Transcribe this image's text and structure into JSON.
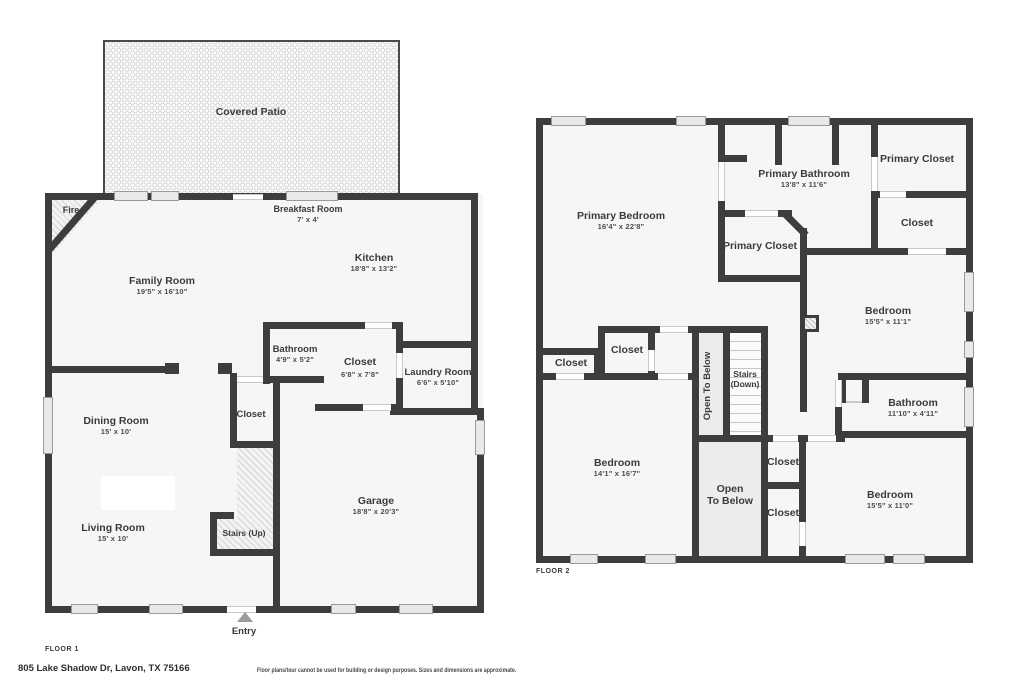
{
  "colors": {
    "wall": "#3d3d3d",
    "floor": "#f6f6f6",
    "background": "#ffffff",
    "shaded": "#ececec",
    "label_text": "#3b3b3b"
  },
  "footer": {
    "address": "805 Lake Shadow Dr, Lavon, TX 75166",
    "disclaimer": "Floor plans/tour cannot be used for building or design purposes. Sizes and dimensions are approximate."
  },
  "floor1": {
    "label": "FLOOR 1",
    "rooms": {
      "covered_patio": {
        "name": "Covered Patio"
      },
      "breakfast": {
        "name": "Breakfast Room",
        "dims": "7' x 4'"
      },
      "kitchen": {
        "name": "Kitchen",
        "dims": "18'8\" x 13'2\""
      },
      "family": {
        "name": "Family Room",
        "dims": "19'5\" x 16'10\""
      },
      "fire": {
        "name": "Fire"
      },
      "bathroom": {
        "name": "Bathroom",
        "dims": "4'9\" x 5'2\""
      },
      "closet_center": {
        "name": "Closet",
        "dims": "6'8\" x 7'8\""
      },
      "laundry": {
        "name": "Laundry Room",
        "dims": "6'6\" x 5'10\""
      },
      "dining": {
        "name": "Dining Room",
        "dims": "15' x 10'"
      },
      "closet_stairs": {
        "name": "Closet"
      },
      "living": {
        "name": "Living Room",
        "dims": "15' x 10'"
      },
      "stairs": {
        "name": "Stairs (Up)"
      },
      "garage": {
        "name": "Garage",
        "dims": "18'8\" x 20'3\""
      },
      "entry": {
        "name": "Entry"
      }
    }
  },
  "floor2": {
    "label": "FLOOR 2",
    "rooms": {
      "primary_bedroom": {
        "name": "Primary Bedroom",
        "dims": "16'4\" x 22'8\""
      },
      "primary_bathroom": {
        "name": "Primary Bathroom",
        "dims": "13'8\" x 11'6\""
      },
      "primary_closet_tr": {
        "name": "Primary Closet"
      },
      "closet_r": {
        "name": "Closet"
      },
      "primary_closet_mid": {
        "name": "Primary Closet"
      },
      "bedroom_ne": {
        "name": "Bedroom",
        "dims": "15'5\" x 11'1\""
      },
      "closet_l": {
        "name": "Closet"
      },
      "closet_m": {
        "name": "Closet"
      },
      "open_below_col": {
        "name": "Open To Below"
      },
      "stairs_down": {
        "line1": "Stairs",
        "line2": "(Down)"
      },
      "bathroom": {
        "name": "Bathroom",
        "dims": "11'10\" x 4'11\""
      },
      "bedroom_w": {
        "name": "Bedroom",
        "dims": "14'1\" x 16'7\""
      },
      "closet_c1": {
        "name": "Closet"
      },
      "open_below_main": {
        "line1": "Open",
        "line2": "To Below"
      },
      "closet_c2": {
        "name": "Closet"
      },
      "bedroom_se": {
        "name": "Bedroom",
        "dims": "15'5\" x 11'0\""
      }
    }
  }
}
